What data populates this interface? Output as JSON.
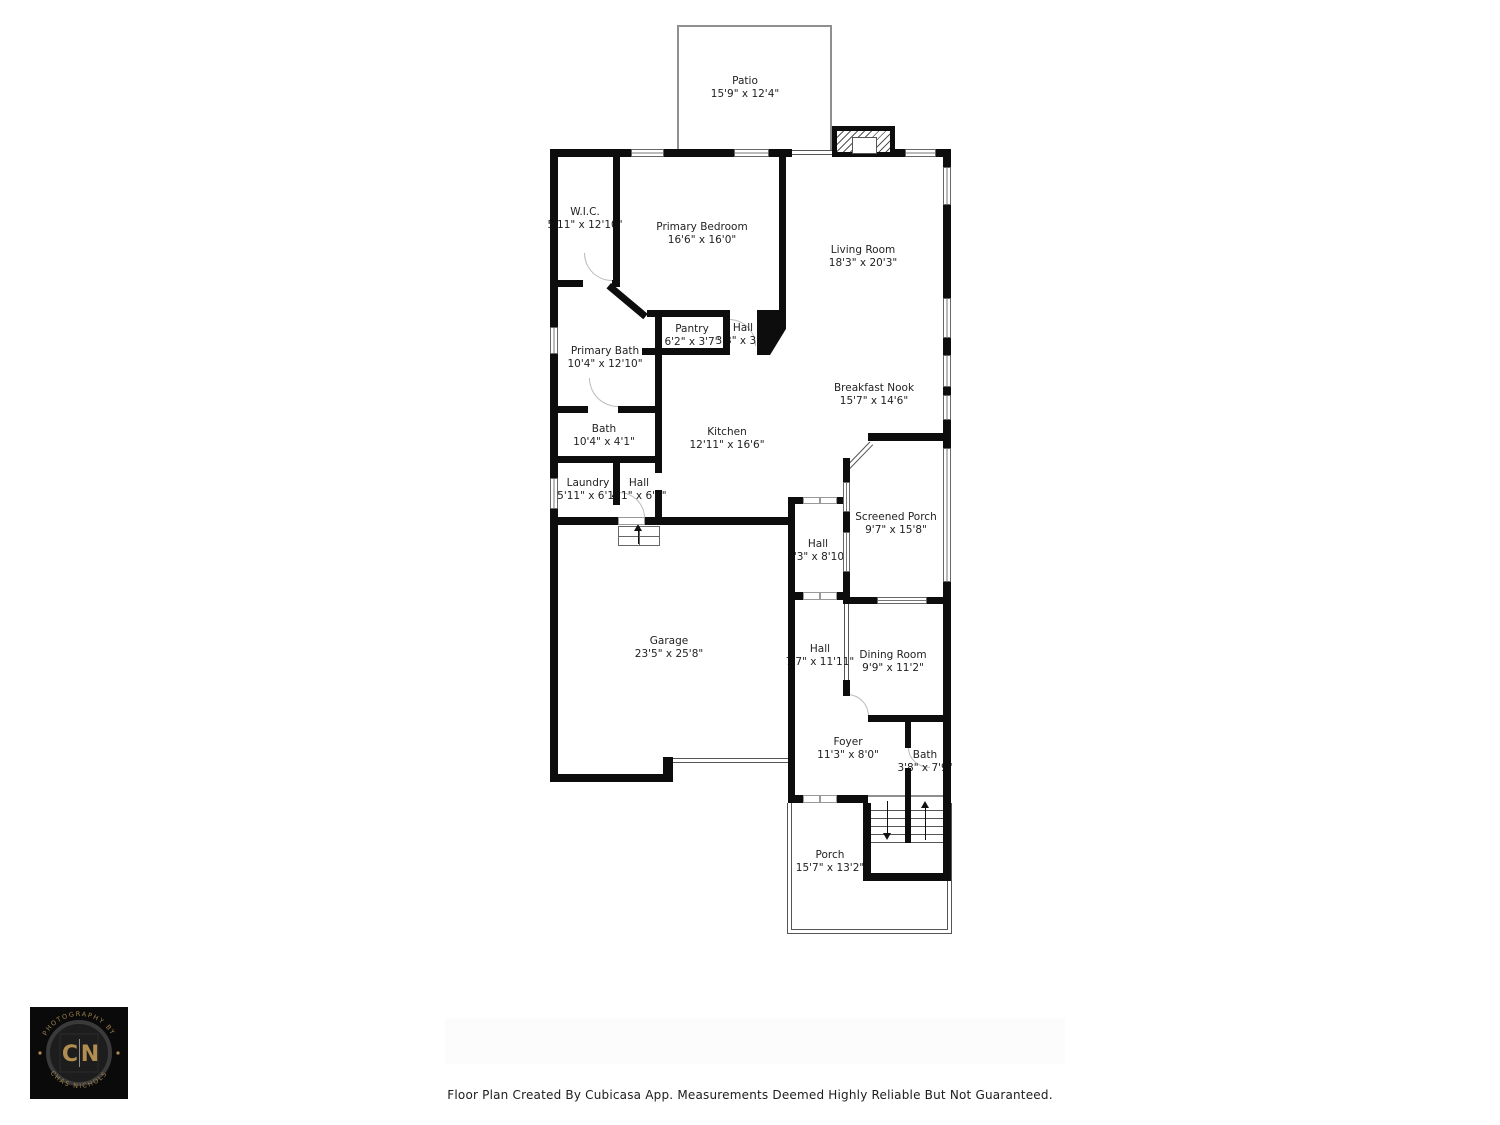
{
  "footer": {
    "text": "Floor Plan Created By Cubicasa App. Measurements Deemed Highly Reliable But Not Guaranteed."
  },
  "logo": {
    "arc_top": "PHOTOGRAPHY BY",
    "arc_bottom": "CHAS NICHOLS",
    "initial_left": "C",
    "initial_right": "N",
    "gold_color": "#b08e52",
    "background_color": "#0a0a0a"
  },
  "floorplan": {
    "wall_color": "#0d0d0d",
    "rooms": [
      {
        "name": "Patio",
        "dims": "15'9\" x 12'4\""
      },
      {
        "name": "W.I.C.",
        "dims": "5'11\" x 12'10\""
      },
      {
        "name": "Primary Bedroom",
        "dims": "16'6\" x 16'0\""
      },
      {
        "name": "Living Room",
        "dims": "18'3\" x 20'3\""
      },
      {
        "name": "Pantry",
        "dims": "6'2\" x 3'7\""
      },
      {
        "name": "Hall",
        "dims": "3'3\" x 3'7\""
      },
      {
        "name": "Primary Bath",
        "dims": "10'4\" x 12'10\""
      },
      {
        "name": "Breakfast Nook",
        "dims": "15'7\" x 14'6\""
      },
      {
        "name": "Bath",
        "dims": "10'4\" x 4'1\""
      },
      {
        "name": "Kitchen",
        "dims": "12'11\" x 16'6\""
      },
      {
        "name": "Laundry",
        "dims": "5'11\" x 6'1\""
      },
      {
        "name": "Hall",
        "dims": "4'1\" x 6'1\""
      },
      {
        "name": "Screened Porch",
        "dims": "9'7\" x 15'8\""
      },
      {
        "name": "Hall",
        "dims": "5'3\" x 8'10\""
      },
      {
        "name": "Garage",
        "dims": "23'5\" x 25'8\""
      },
      {
        "name": "Hall",
        "dims": "7'7\" x 11'11\""
      },
      {
        "name": "Dining Room",
        "dims": "9'9\" x 11'2\""
      },
      {
        "name": "Foyer",
        "dims": "11'3\" x 8'0\""
      },
      {
        "name": "Bath",
        "dims": "3'8\" x 7'9\""
      },
      {
        "name": "Porch",
        "dims": "15'7\" x 13'2\""
      }
    ]
  }
}
